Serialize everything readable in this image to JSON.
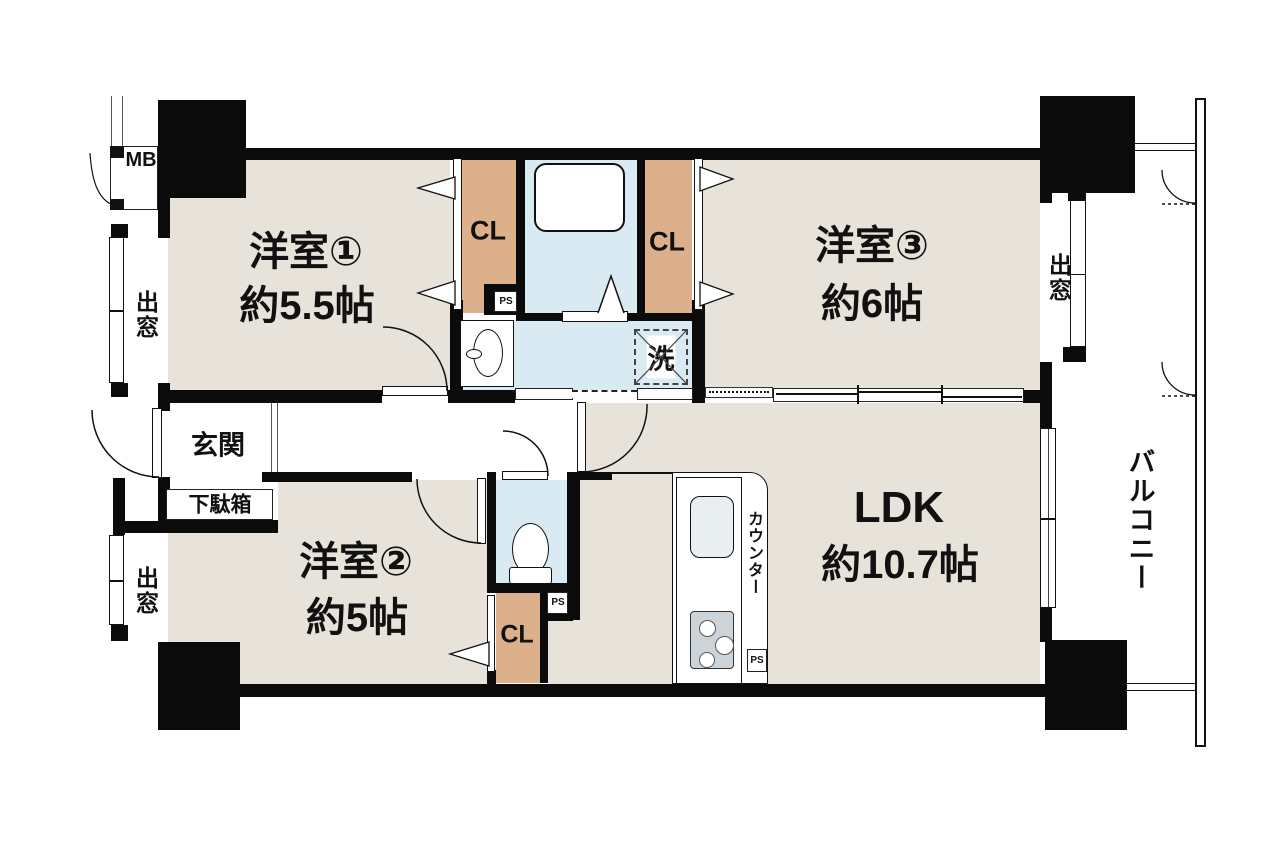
{
  "plan_title": "2LDK apartment floor plan",
  "colors": {
    "room_floor": "#e8e3da",
    "wet_area": "#daeaf3",
    "closet": "#ddb08c",
    "wall": "#0b0b0b",
    "stove": "#ccd3d9"
  },
  "rooms": {
    "room1": {
      "name": "洋室①",
      "size": "約5.5帖"
    },
    "room2": {
      "name": "洋室②",
      "size": "約5帖"
    },
    "room3": {
      "name": "洋室③",
      "size": "約6帖"
    },
    "ldk": {
      "name": "LDK",
      "size": "約10.7帖"
    },
    "entrance": {
      "name": "玄関"
    },
    "shoe_cabinet": {
      "name": "下駄箱"
    },
    "balcony": {
      "name": "バルコニー"
    },
    "kitchen_counter": {
      "name": "カウンター"
    }
  },
  "labels": {
    "closet": "CL",
    "pipe_space": "PS",
    "meter_box": "MB",
    "bay_window": "出窓",
    "laundry": "洗"
  }
}
